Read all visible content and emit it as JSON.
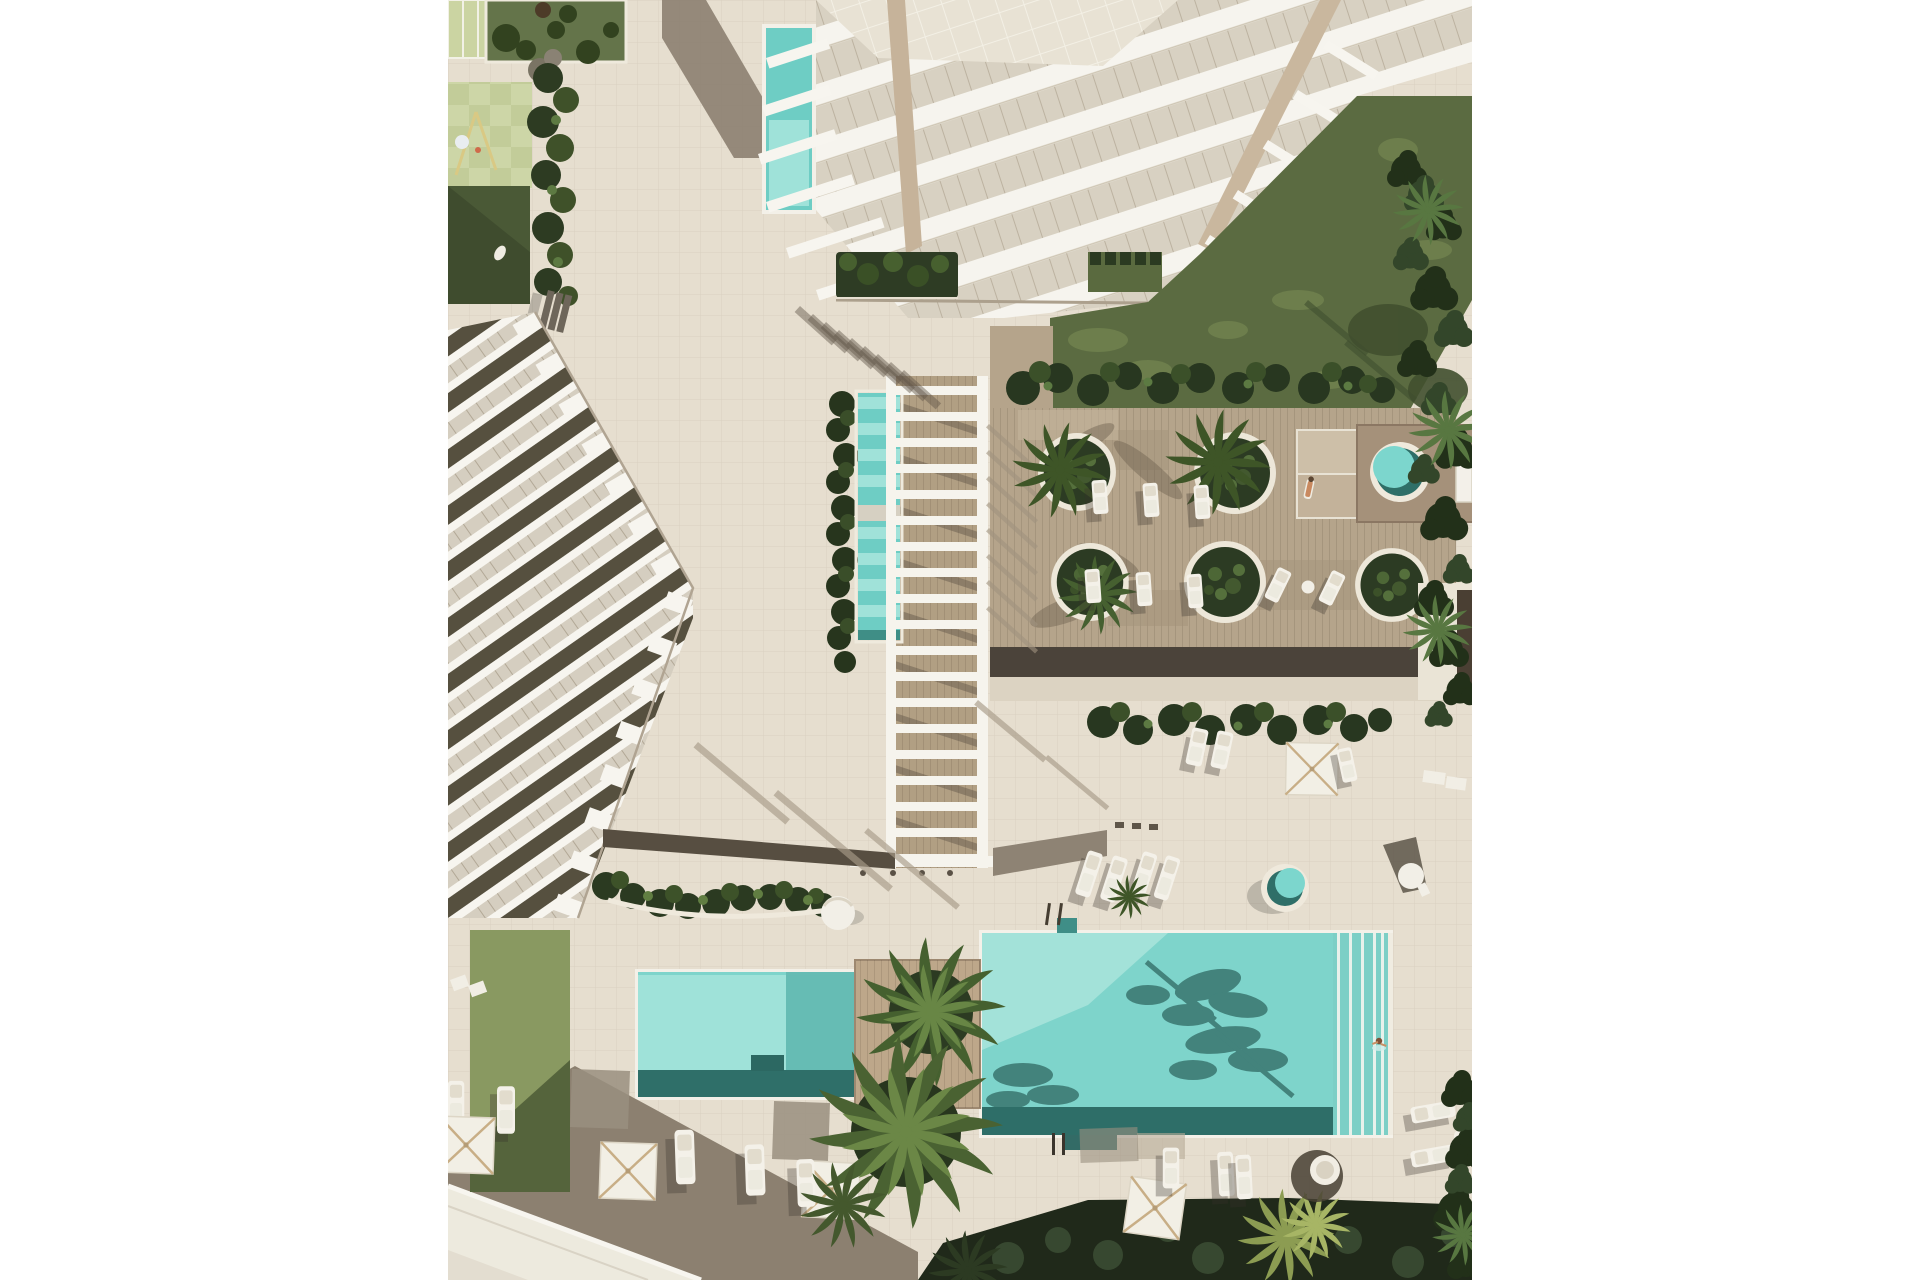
{
  "page": {
    "background": "#ffffff",
    "layout": "white letterbox bars left and right, centered 1024x1280 portrait render",
    "content_left_px": 448,
    "content_width_px": 1024,
    "content_height_px": 1280
  },
  "image": {
    "kind": "aerial top-down 3D architectural rendering",
    "subject": "residential resort courtyard with swimming pools, wooden deck, pergola walkway, lawns and two white apartment buildings",
    "lighting": "hard daylight with long shadows cast toward lower left"
  },
  "colors": {
    "pavement": "#e6decf",
    "shadowTaupe": "#8c8070",
    "walkwayDark": "#574e41",
    "road": "#edeade",
    "curb": "#f7f5ef",
    "poolWater": "#7ed4cb",
    "poolLight": "#a9e4dc",
    "poolDark": "#2e6e68",
    "laneZone": "#7ccfc6",
    "lapPool": "#6ecdc4",
    "spaWater": "#7cd6cd",
    "spaShade": "#2f6f68",
    "deckWood": "#b5a48b",
    "deckShadow": "#4b433a",
    "pergolaWhite": "#f6f4ed",
    "buildingWhite": "#f6f4ee",
    "buildingGlass": "#d8d1c2",
    "roofDark": "#56503f",
    "woodSpine": "#c6b39a",
    "grassField": "#5b6b41",
    "grassLight": "#93a267",
    "hedgeDark": "#2d3b22",
    "hedgeLight": "#4d6736",
    "plantingDark": "#20291a",
    "playgroundTileA": "#cdd6a7",
    "playgroundTileB": "#c2cc99",
    "lawnCanopy": "#cbd4a2",
    "umbrellaWhite": "#f2efe5",
    "umbrellaRib": "#c8ae86",
    "loungerWhite": "#f4f1e9"
  },
  "areas": [
    {
      "name": "highrise-building",
      "label": "White high-rise with stepped glass balconies (top)"
    },
    {
      "name": "tower-lap-pool",
      "label": "Small teal lap pool at tower base"
    },
    {
      "name": "west-building",
      "label": "Angled townhouse building with dark roof strips (left)"
    },
    {
      "name": "pergola",
      "label": "White ladder pergola over central lap pool"
    },
    {
      "name": "pergola-lap-pool",
      "label": "Central lap pool under pergola"
    },
    {
      "name": "wood-deck",
      "label": "Wooden deck terrace with round planters and loungers"
    },
    {
      "name": "spa-deck",
      "label": "East deck platform with round spa tub"
    },
    {
      "name": "main-pool",
      "label": "Large main pool with swim-lane edge and palm shadows"
    },
    {
      "name": "kids-pool",
      "label": "Smaller secondary pool (bottom left of main pool)"
    },
    {
      "name": "playground",
      "label": "Checkerboard playground with swing set (top left)"
    },
    {
      "name": "east-lawn",
      "label": "Lawn between tower and deck"
    },
    {
      "name": "south-planting-bed",
      "label": "Dense dark planting bed along bottom edge"
    },
    {
      "name": "access-road",
      "label": "Diagonal access road (bottom left corner)"
    }
  ],
  "objects": {
    "rectangular_pools": 4,
    "round_spa_tubs": 2,
    "round_planters": 5,
    "square_parasols": 6,
    "sun_loungers": 24,
    "benches": 1,
    "swing_set": 1,
    "people": 2,
    "palm_trees": "multiple"
  }
}
